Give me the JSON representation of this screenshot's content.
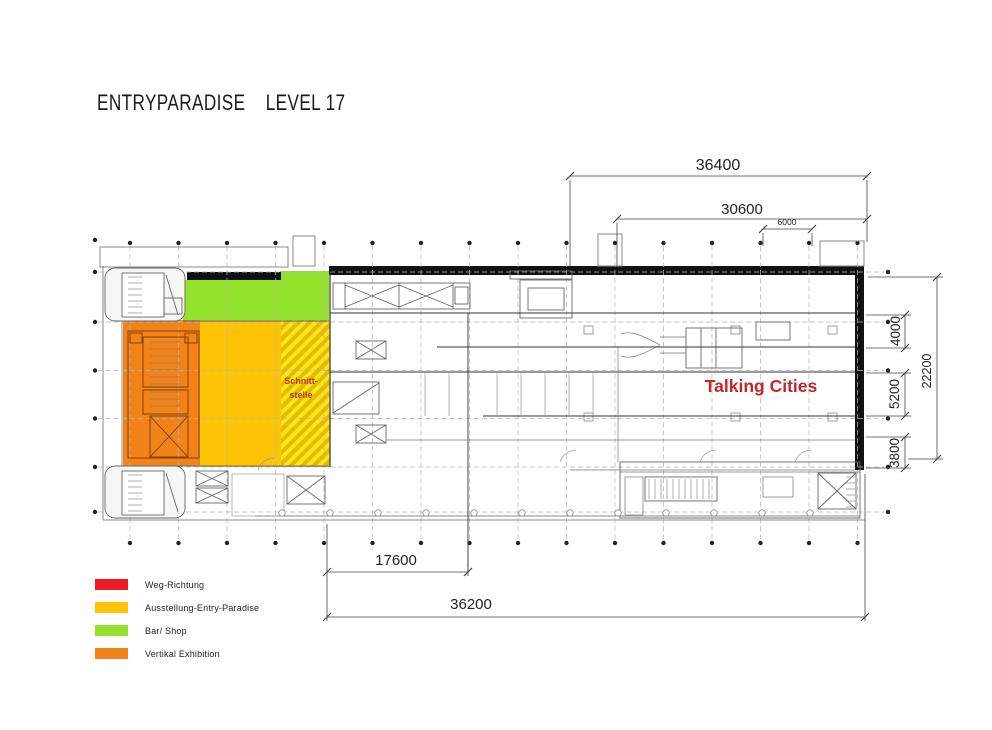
{
  "title": {
    "project": "ENTRYPARADISE",
    "level": "LEVEL 17"
  },
  "plan_labels": {
    "talking_cities": "Talking Cities",
    "schnittstelle_line1": "Schnitt-",
    "schnittstelle_line2": "stelle"
  },
  "dimensions_mm": {
    "top_overall": "36400",
    "top_inner": "30600",
    "top_bay": "6000",
    "right_upper": "4000",
    "right_middle": "5200",
    "right_lower": "3800",
    "right_overall": "22200",
    "bottom_inner": "17600",
    "bottom_overall": "36200"
  },
  "legend": {
    "items": [
      {
        "id": "weg-richtung",
        "label": "Weg-Richtung",
        "color": "#ec1c23"
      },
      {
        "id": "ausstellung-entry-paradise",
        "label": "Ausstellung-Entry-Paradise",
        "color": "#fcc405"
      },
      {
        "id": "bar-shop",
        "label": "Bar/ Shop",
        "color": "#94e22c"
      },
      {
        "id": "vertikal-exhibition",
        "label": "Vertikal Exhibition",
        "color": "#f2831b"
      }
    ]
  },
  "zones": {
    "bar_shop_color": "#94e22c",
    "ausstellung_color": "#fcc405",
    "vertikal_exhibition_color": "#f2831b",
    "schnittstelle_hatch_colors": [
      "#ffe714",
      "#e3bb05"
    ]
  },
  "colors": {
    "talking_cities_red": "#c4262c",
    "schnittstelle_red": "#b03a2e",
    "wall_black": "#111111"
  }
}
